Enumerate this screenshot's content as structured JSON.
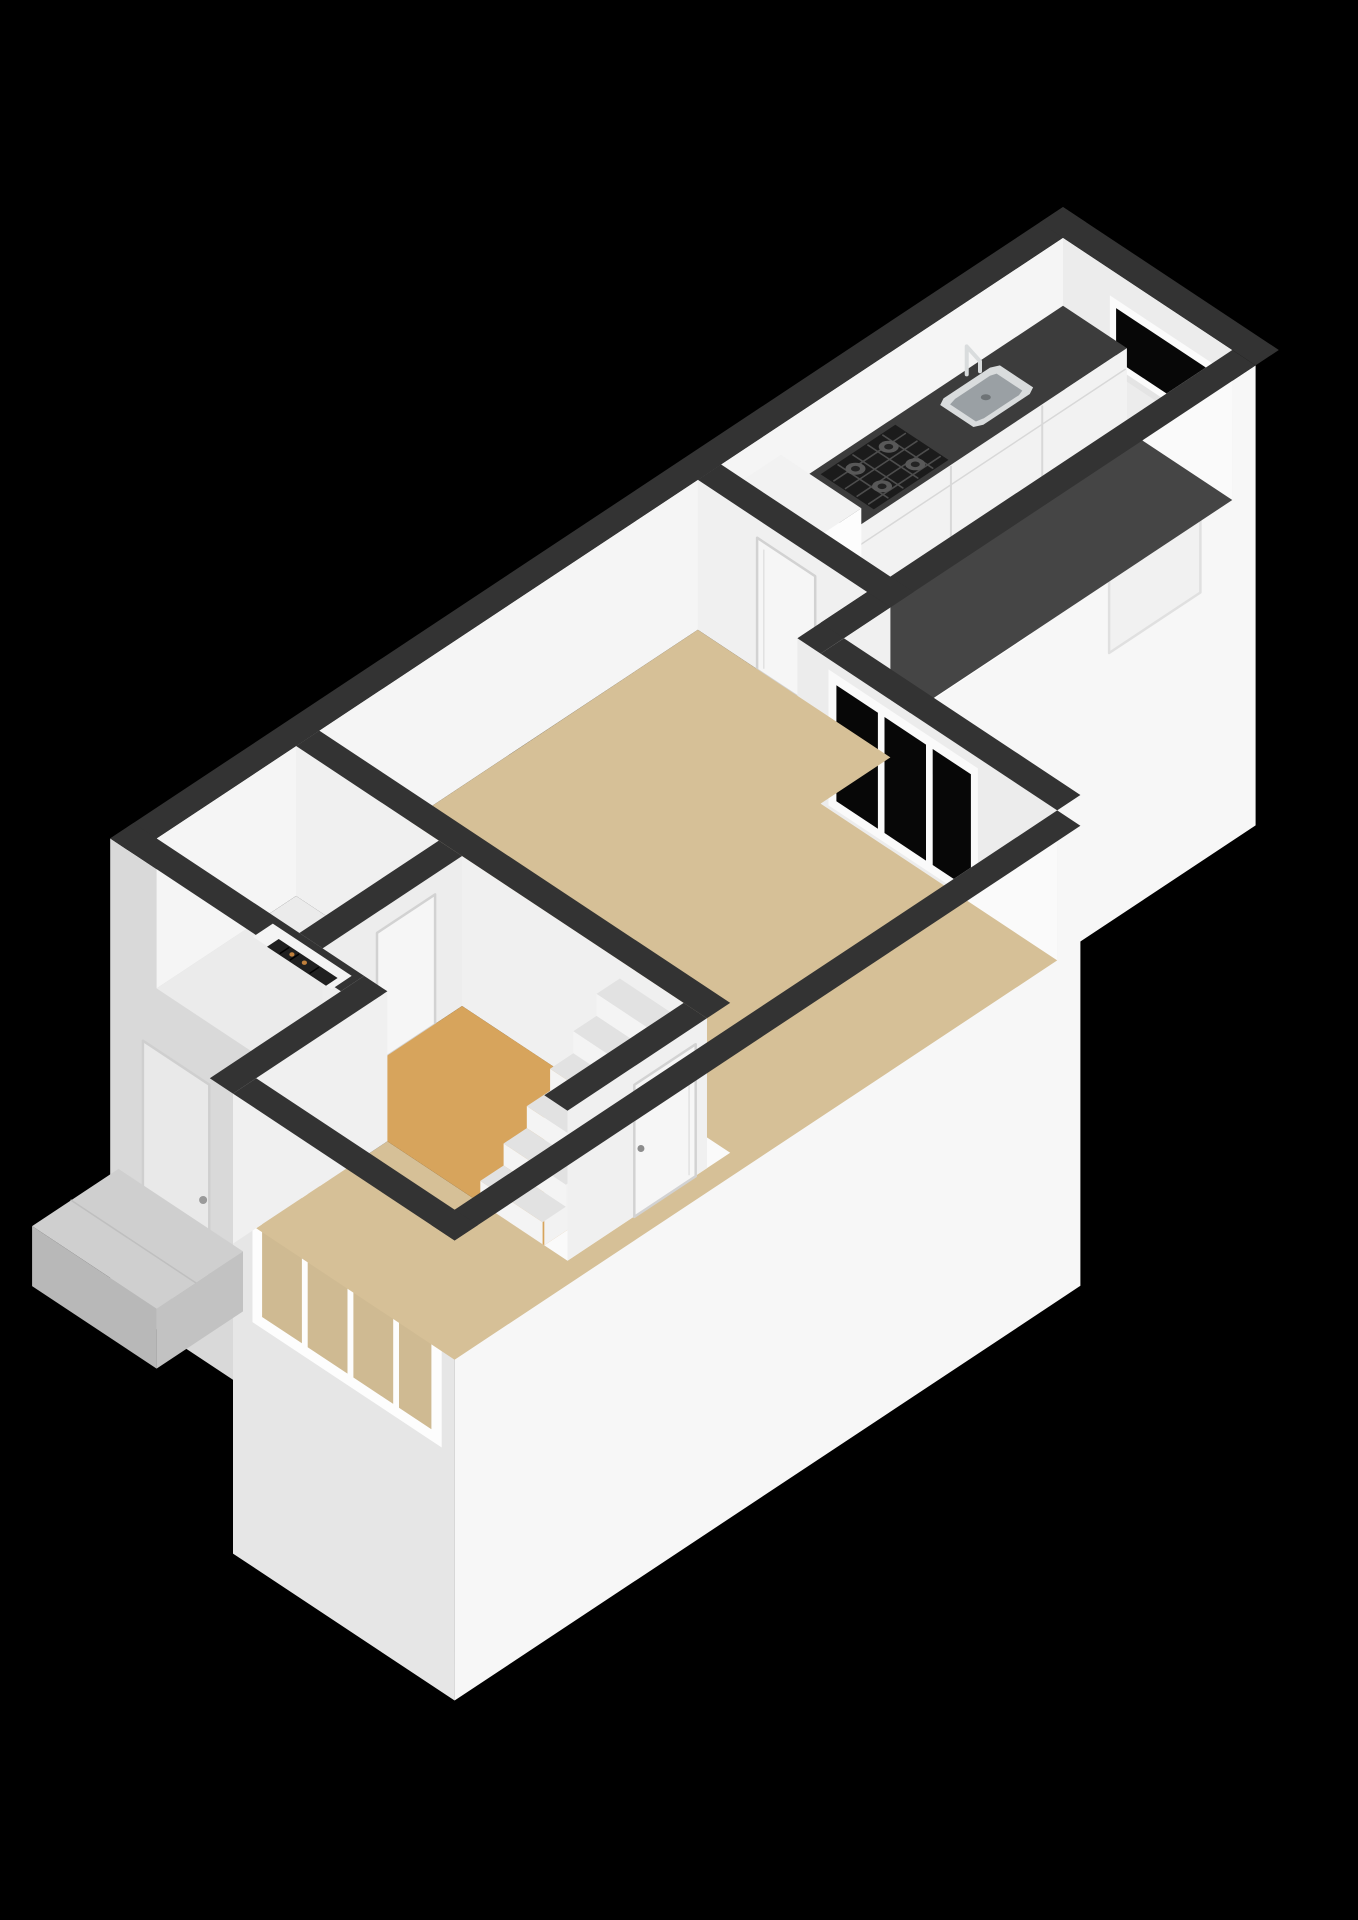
{
  "scene": {
    "description": "3D isometric floor plan rendering of a one-floor apartment on a black background",
    "background": "#000000"
  },
  "colors": {
    "background": "#000000",
    "wallTop": "#333333",
    "wallBright": "#f5f5f5",
    "wallLight": "#ececec",
    "wallMed": "#f0f0f0",
    "wallMed2": "#ededed",
    "innerStrip": "#fafafa",
    "extBright": "#f7f7f7",
    "extShade": "#d9d9d9",
    "extMed": "#e6e6e6",
    "floorKitchen": "#454545",
    "counterTop": "#3c3c3c",
    "cabinetFront": "#f2f2f2",
    "cabinetSeam": "#d8d8d8",
    "floorLiving": "#d6c097",
    "floorHall": "#d7a45c",
    "floorToilet": "#ebebeb",
    "doorFill": "#f6f6f6",
    "doorFrame": "#d2d2d2",
    "handle": "#8c8c8c",
    "glassDark": "#070707",
    "glassSky": "#ccd8e3",
    "glassFloor": "#cfba92",
    "steelRim": "#d9dcdd",
    "steelBasin": "#9aa0a4",
    "steelDrain": "#6e7376",
    "hobBlack": "#1b1b1b",
    "hobGrid": "#4d4d4d",
    "burnerOuter": "#585858",
    "burnerInner": "#232323",
    "stairTread": "#e2e2e2",
    "stairRiser": "#f4f4f4",
    "fridgeTop": "#f2f2f2",
    "fridgeFront": "#fdfdfd",
    "fridgeSide": "#e7e7e7",
    "nicheInner": "#f4f4f4",
    "heaterDark": "#202020",
    "heaterKnob": "#c0803c",
    "porchTop": "#cfcfcf",
    "porchFront": "#b8b8b8",
    "porchSide": "#c2c2c2"
  },
  "rooms": [
    {
      "id": "living-room",
      "floor": "beige"
    },
    {
      "id": "kitchen",
      "floor": "dark-gray"
    },
    {
      "id": "hallway",
      "floor": "orange"
    },
    {
      "id": "toilet",
      "floor": "light-gray"
    }
  ],
  "features": [
    "staircase",
    "kitchen-counter",
    "kitchen-sink",
    "kitchen-faucet",
    "gas-hob",
    "tall-cabinet",
    "slit-window",
    "back-door",
    "garden-window",
    "black-window",
    "panorama-window",
    "front-door",
    "interior-doors",
    "heater-niche",
    "entrance-porch"
  ]
}
